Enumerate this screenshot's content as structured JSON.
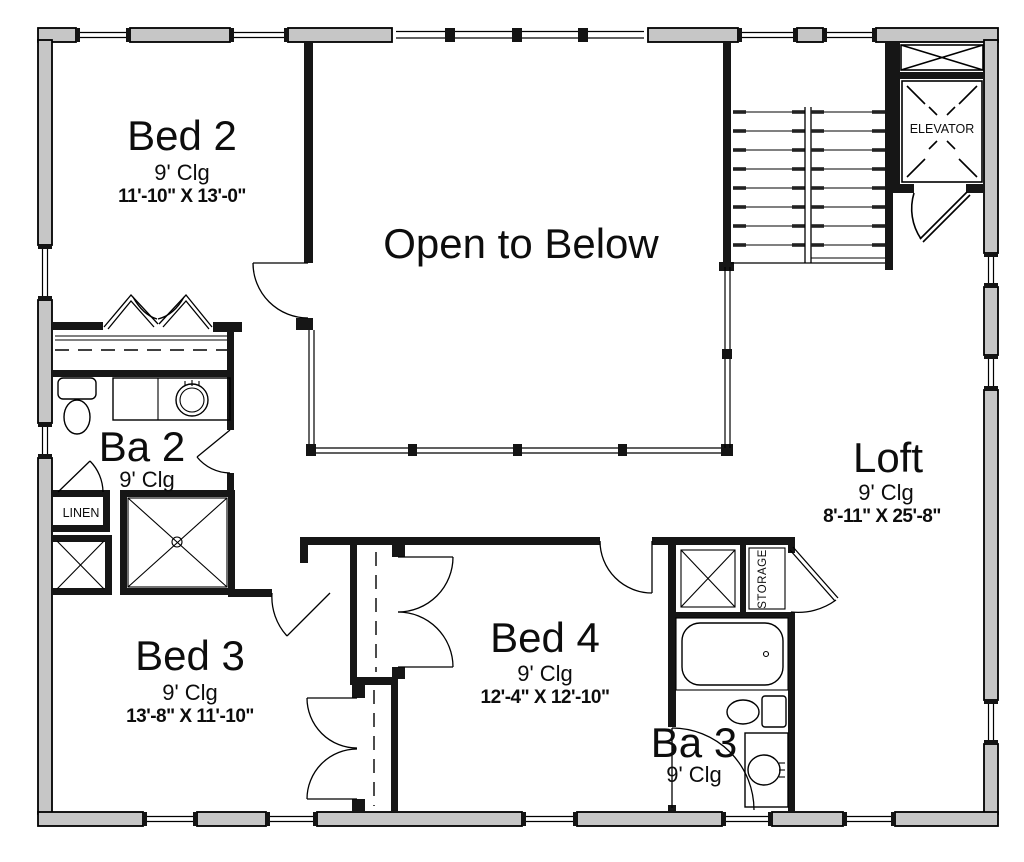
{
  "plan": {
    "rooms": {
      "bed2": {
        "name": "Bed 2",
        "ceiling": "9' Clg",
        "dims": "11'-10\" X 13'-0\""
      },
      "bed3": {
        "name": "Bed 3",
        "ceiling": "9' Clg",
        "dims": "13'-8\" X 11'-10\""
      },
      "bed4": {
        "name": "Bed 4",
        "ceiling": "9' Clg",
        "dims": "12'-4\" X 12'-10\""
      },
      "loft": {
        "name": "Loft",
        "ceiling": "9' Clg",
        "dims": "8'-11\" X 25'-8\""
      },
      "ba2": {
        "name": "Ba 2",
        "ceiling": "9' Clg"
      },
      "ba3": {
        "name": "Ba 3",
        "ceiling": "9' Clg"
      },
      "open_to_below": {
        "name": "Open to Below"
      },
      "elevator": {
        "name": "ELEVATOR"
      },
      "linen": {
        "name": "LINEN"
      },
      "storage": {
        "name": "STORAGE"
      }
    },
    "colors": {
      "exterior_wall_fill": "#c6c6c6",
      "interior_wall": "#161616",
      "line": "#000000",
      "background": "#ffffff"
    }
  }
}
